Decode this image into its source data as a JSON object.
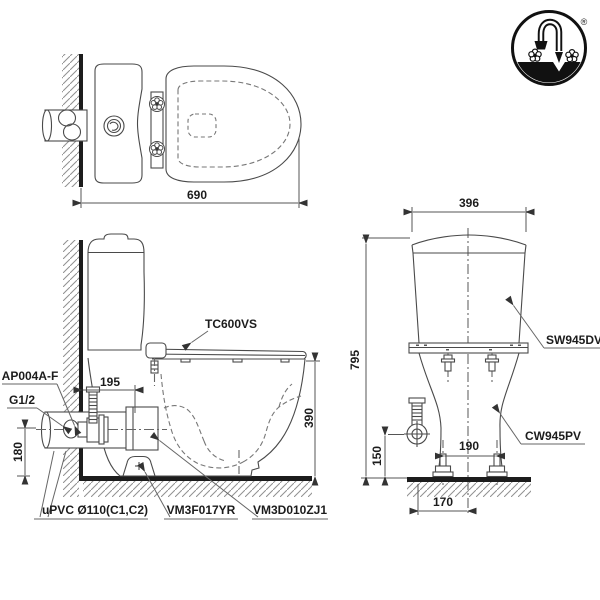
{
  "document": {
    "type": "two-piece toilet installation technical drawing",
    "background": "#ffffff",
    "line_color": "#4a4a4a",
    "heavy_line_color": "#1c1c1c",
    "dashed_line_color": "#777777"
  },
  "logo": {
    "description": "circular brand mark with gooseneck faucet, two flower handles and black basin",
    "registered_mark": "®"
  },
  "top_view": {
    "dim_overall_depth": "690"
  },
  "side_view": {
    "dim_wall_to_bolt": "195",
    "dim_rim_height": "390",
    "dim_inlet_height": "180",
    "label_seat": "TC600VS",
    "label_angle_valve": "AP004A-F",
    "label_thread": "G1/2",
    "label_drain_pipe": "uPVC Ø110(C1,C2)",
    "label_floor_flange": "VM3F017YR",
    "label_connector": "VM3D010ZJ1"
  },
  "front_view": {
    "dim_tank_width": "396",
    "dim_total_height": "795",
    "dim_inlet_height": "150",
    "dim_bolt_spacing": "190",
    "dim_center_offset": "170",
    "label_tank": "SW945DV",
    "label_bowl": "CW945PV"
  }
}
